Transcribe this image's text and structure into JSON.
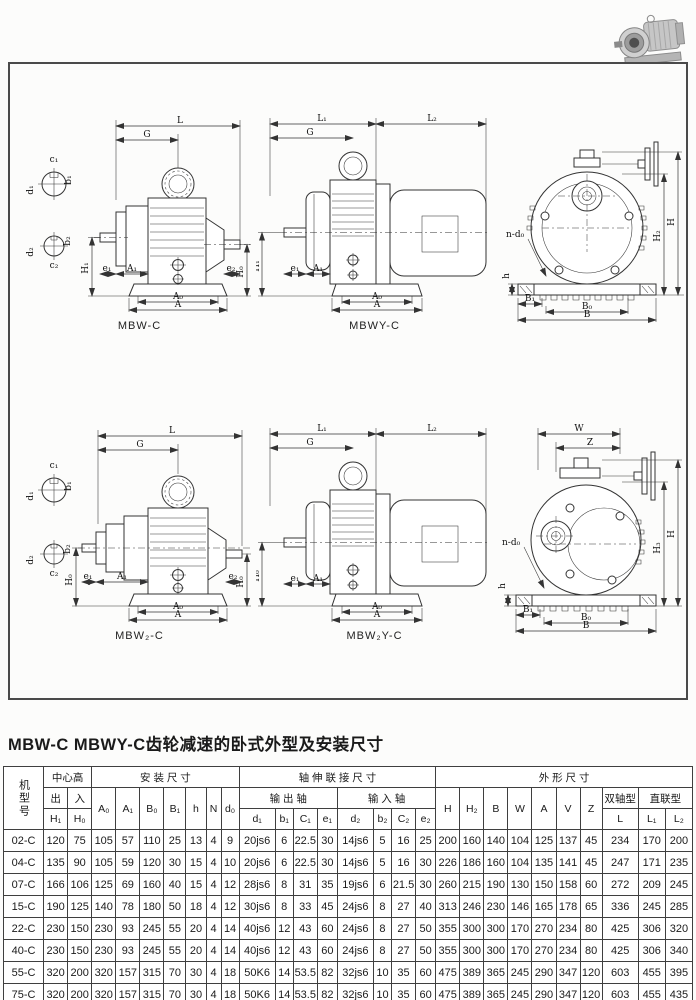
{
  "page": {
    "title": "MBW-C MBWY-C齿轮减速的卧式外型及安装尺寸"
  },
  "dims": {
    "L": "L",
    "G": "G",
    "L1": "L₁",
    "L2": "L₂",
    "H1": "H₁",
    "H0": "H₀",
    "H": "H",
    "H2": "H₂",
    "H3": "H₃",
    "A": "A",
    "A0": "A₀",
    "A1": "A₁",
    "e1": "e₁",
    "e2": "e₂",
    "c1": "c₁",
    "b1": "b₁",
    "c2": "c₂",
    "b2": "b₂",
    "d1": "d₁",
    "d2": "d₂",
    "ndo": "n-d₀",
    "h": "h",
    "B": "B",
    "B0": "B₀",
    "B1": "B₁",
    "W": "W",
    "Z": "Z"
  },
  "captions": {
    "d1": "MBW-C",
    "d2": "MBWY-C",
    "d4": "MBW₂-C",
    "d5": "MBW₂Y-C"
  },
  "table": {
    "header": {
      "model": "机型号",
      "center_height": "中心高",
      "mounting": "安  装  尺  寸",
      "shaft_conn": "轴  伸  联  接  尺  寸",
      "outline": "外  形  尺  寸",
      "out": "出",
      "in": "入",
      "output_shaft": "输 出 轴",
      "input_shaft": "输 入 轴",
      "double_shaft": "双轴型",
      "direct": "直联型",
      "H1": "H₁",
      "H0": "H₀",
      "A0": "A₀",
      "A1": "A₁",
      "B0": "B₀",
      "B1": "B₁",
      "h": "h",
      "N": "N",
      "d0": "d₀",
      "d1": "d₁",
      "b1": "b₁",
      "C1": "C₁",
      "e1": "e₁",
      "d2": "d₂",
      "b2": "b₂",
      "C2": "C₂",
      "e2": "e₂",
      "H": "H",
      "H2": "H₂",
      "B": "B",
      "W": "W",
      "A": "A",
      "V": "V",
      "Z": "Z",
      "L": "L",
      "L1": "L₁",
      "L2": "L₂"
    },
    "rows": [
      [
        "02-C",
        "120",
        "75",
        "105",
        "57",
        "110",
        "25",
        "13",
        "4",
        "9",
        "20js6",
        "6",
        "22.5",
        "30",
        "14js6",
        "5",
        "16",
        "25",
        "200",
        "160",
        "140",
        "104",
        "125",
        "137",
        "45",
        "234",
        "170",
        "200"
      ],
      [
        "04-C",
        "135",
        "90",
        "105",
        "59",
        "120",
        "30",
        "15",
        "4",
        "10",
        "20js6",
        "6",
        "22.5",
        "30",
        "14js6",
        "5",
        "16",
        "30",
        "226",
        "186",
        "160",
        "104",
        "135",
        "141",
        "45",
        "247",
        "171",
        "235"
      ],
      [
        "07-C",
        "166",
        "106",
        "125",
        "69",
        "160",
        "40",
        "15",
        "4",
        "12",
        "28js6",
        "8",
        "31",
        "35",
        "19js6",
        "6",
        "21.5",
        "30",
        "260",
        "215",
        "190",
        "130",
        "150",
        "158",
        "60",
        "272",
        "209",
        "245"
      ],
      [
        "15-C",
        "190",
        "125",
        "140",
        "78",
        "180",
        "50",
        "18",
        "4",
        "12",
        "30js6",
        "8",
        "33",
        "45",
        "24js6",
        "8",
        "27",
        "40",
        "313",
        "246",
        "230",
        "146",
        "165",
        "178",
        "65",
        "336",
        "245",
        "285"
      ],
      [
        "22-C",
        "230",
        "150",
        "230",
        "93",
        "245",
        "55",
        "20",
        "4",
        "14",
        "40js6",
        "12",
        "43",
        "60",
        "24js6",
        "8",
        "27",
        "50",
        "355",
        "300",
        "300",
        "170",
        "270",
        "234",
        "80",
        "425",
        "306",
        "320"
      ],
      [
        "40-C",
        "230",
        "150",
        "230",
        "93",
        "245",
        "55",
        "20",
        "4",
        "14",
        "40js6",
        "12",
        "43",
        "60",
        "24js6",
        "8",
        "27",
        "50",
        "355",
        "300",
        "300",
        "170",
        "270",
        "234",
        "80",
        "425",
        "306",
        "340"
      ],
      [
        "55-C",
        "320",
        "200",
        "320",
        "157",
        "315",
        "70",
        "30",
        "4",
        "18",
        "50K6",
        "14",
        "53.5",
        "82",
        "32js6",
        "10",
        "35",
        "60",
        "475",
        "389",
        "365",
        "245",
        "290",
        "347",
        "120",
        "603",
        "455",
        "395"
      ],
      [
        "75-C",
        "320",
        "200",
        "320",
        "157",
        "315",
        "70",
        "30",
        "4",
        "18",
        "50K6",
        "14",
        "53.5",
        "82",
        "32js6",
        "10",
        "35",
        "60",
        "475",
        "389",
        "365",
        "245",
        "290",
        "347",
        "120",
        "603",
        "455",
        "435"
      ]
    ]
  }
}
